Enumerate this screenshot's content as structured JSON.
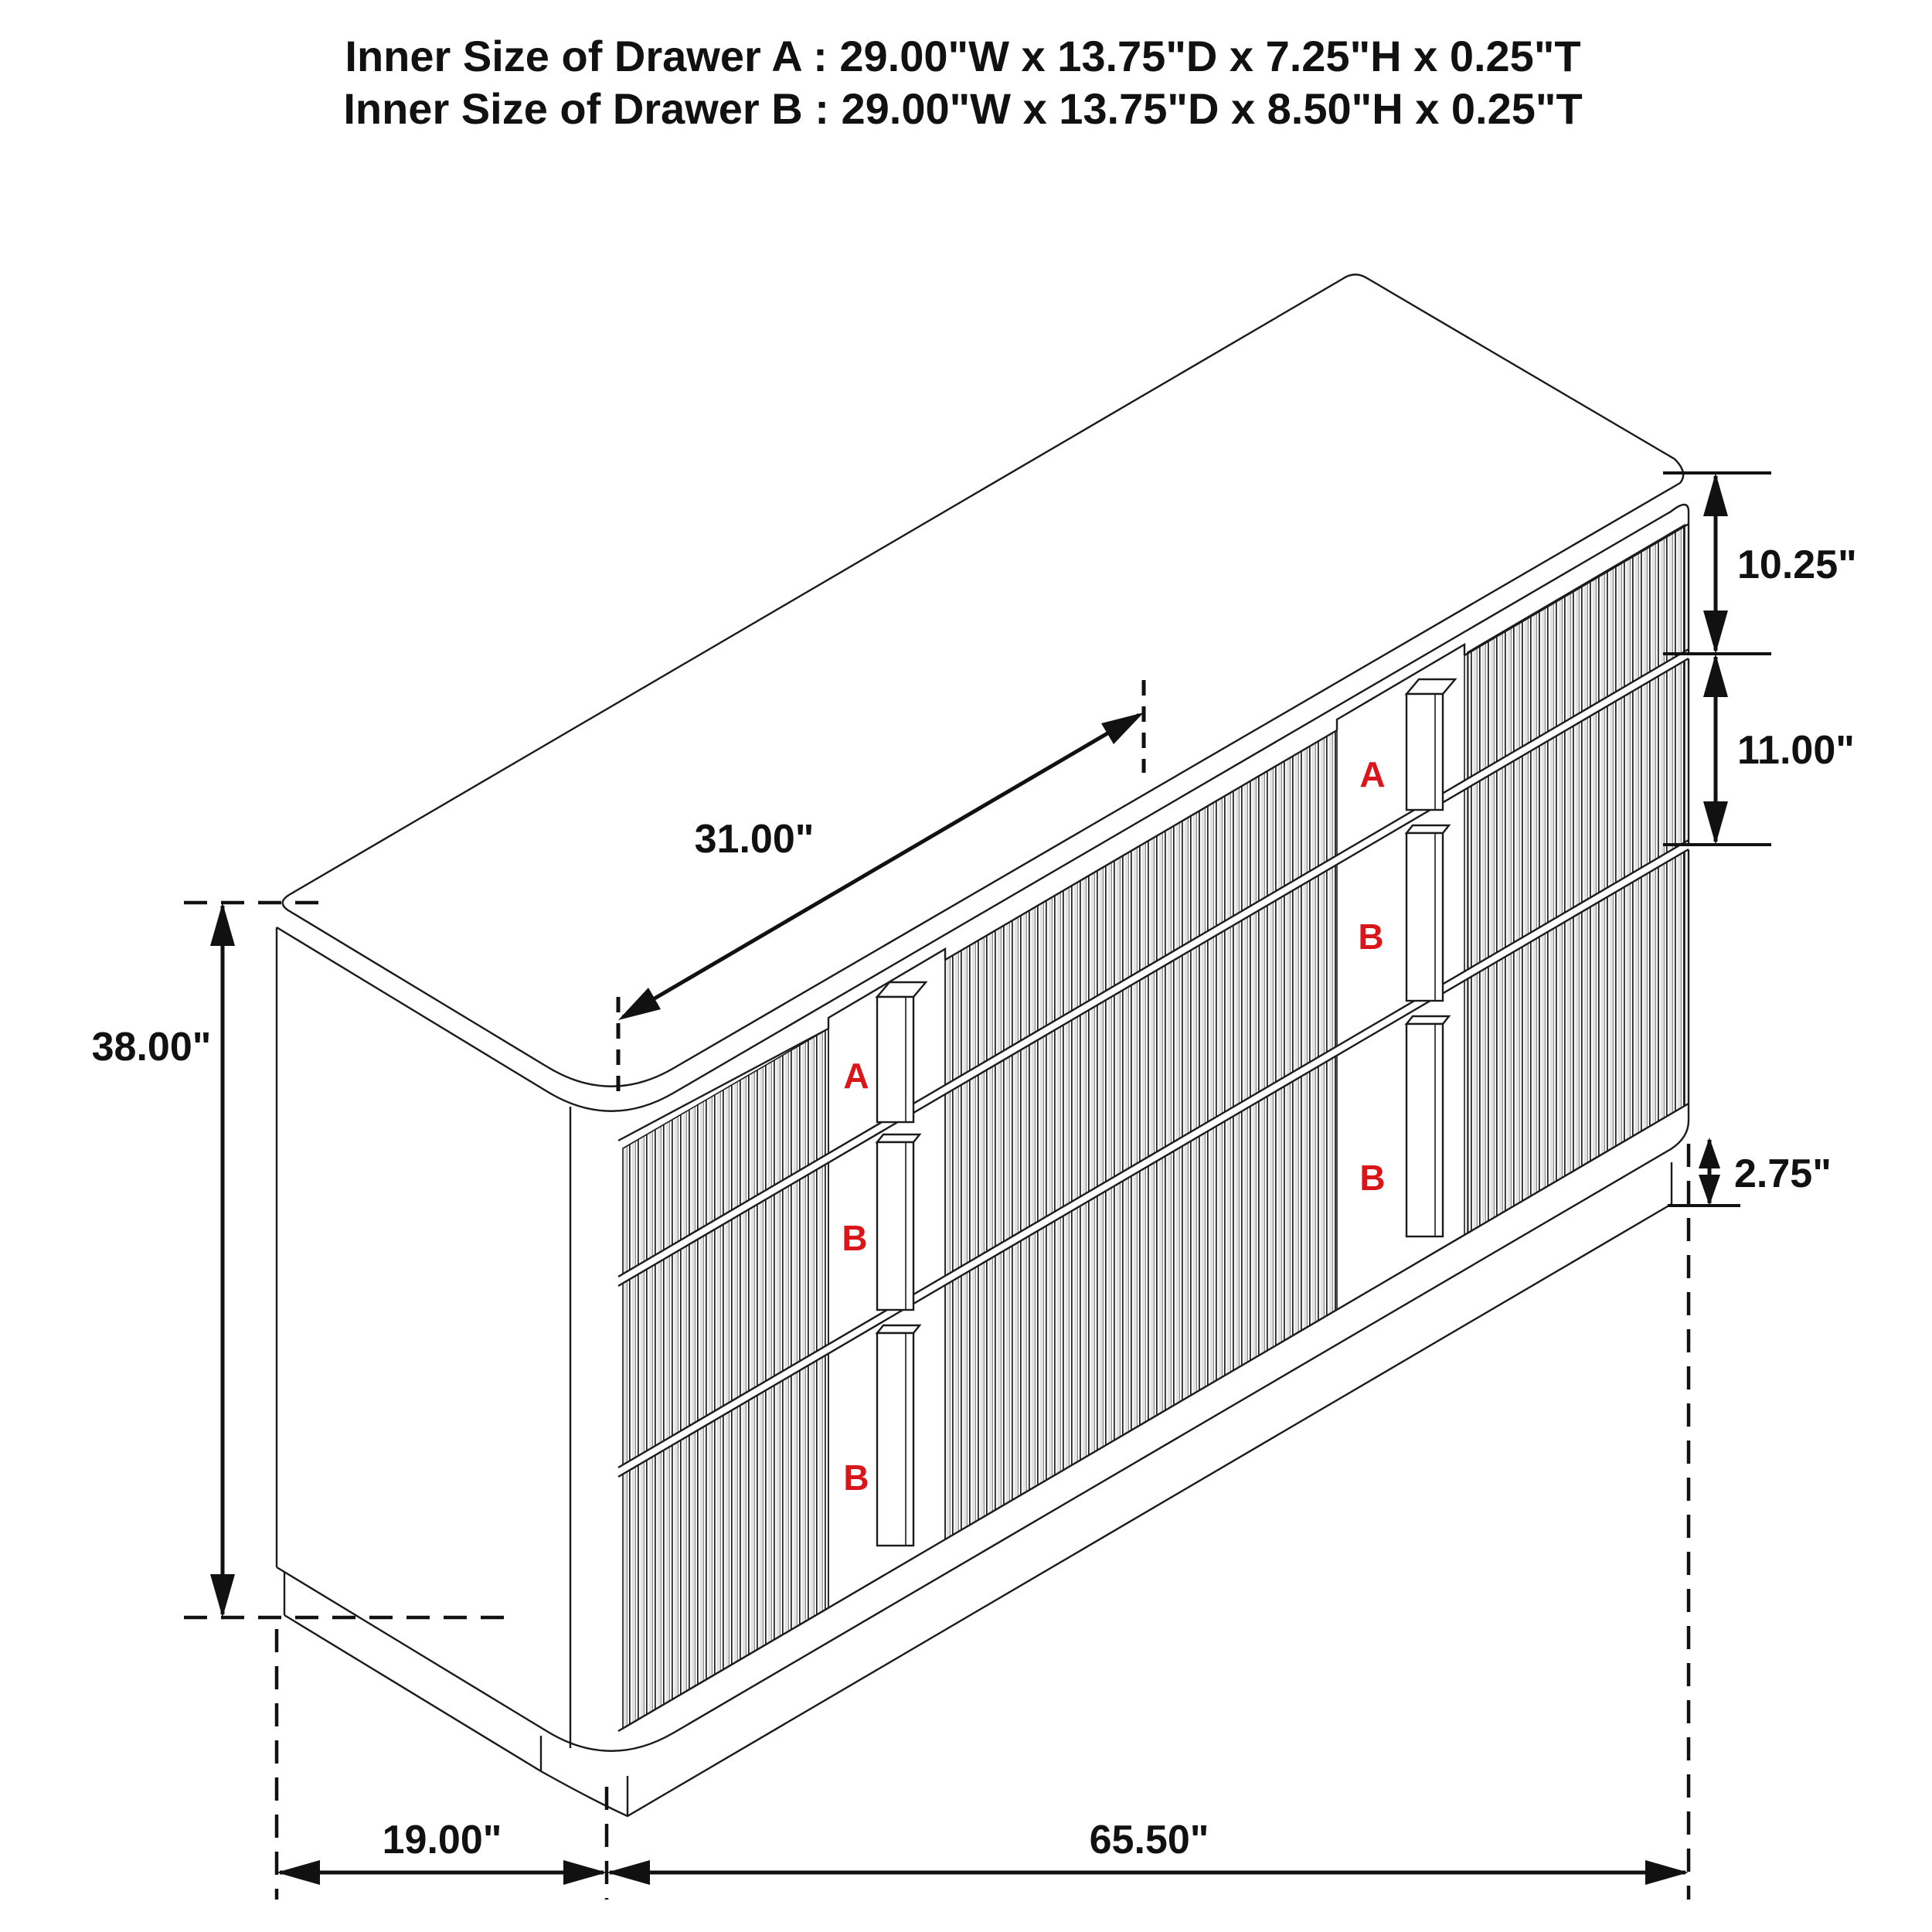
{
  "title": {
    "line1": "Inner Size of Drawer A : 29.00\"W x 13.75\"D x 7.25\"H x 0.25\"T",
    "line2": "Inner Size of Drawer B : 29.00\"W x 13.75\"D x 8.50\"H x 0.25\"T"
  },
  "dimensions": {
    "overall_height": "38.00\"",
    "top_drawer_height": "10.25\"",
    "middle_drawer_height": "11.00\"",
    "base_height": "2.75\"",
    "drawer_opening_width": "31.00\"",
    "overall_depth": "19.00\"",
    "overall_width": "65.50\""
  },
  "drawer_labels": {
    "left_top": "A",
    "left_middle": "B",
    "left_bottom": "B",
    "right_top": "A",
    "right_middle": "B",
    "right_bottom": "B"
  },
  "colors": {
    "label_red": "#d9161a",
    "line_black": "#1b1b1b"
  }
}
